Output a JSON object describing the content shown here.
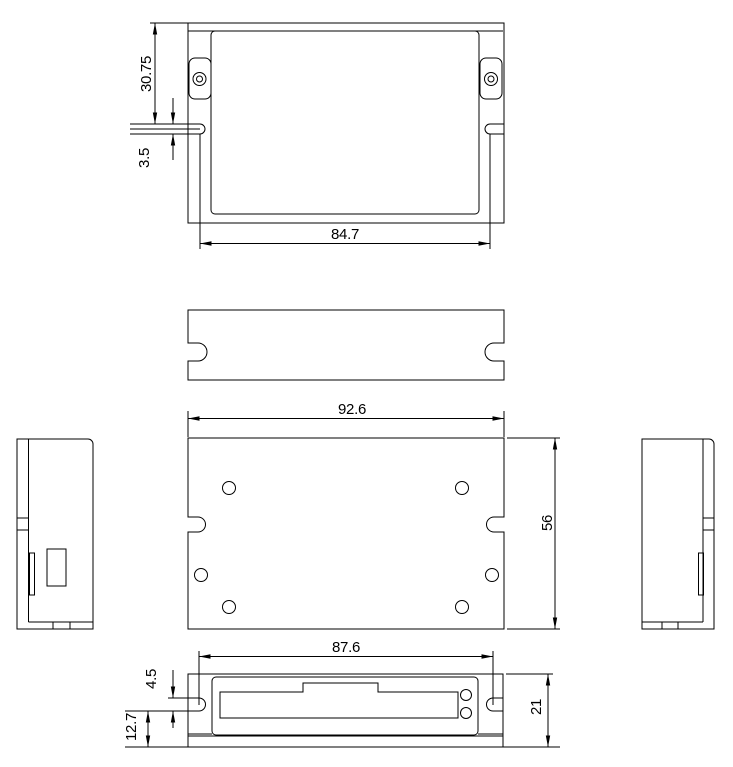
{
  "drawing": {
    "type": "mechanical-orthographic-views",
    "units_shown": false,
    "style": {
      "line_color": "#000000",
      "background_color": "#ffffff",
      "text_color": "#000000"
    }
  },
  "dims": {
    "top": {
      "edge_to_slot": "30.75",
      "slot_width": "3.5",
      "slot_spacing": "84.7"
    },
    "plan": {
      "overall_width": "92.6",
      "overall_depth": "56"
    },
    "front": {
      "slot_spacing": "87.6",
      "slot_width": "4.5",
      "slot_to_base": "12.7",
      "overall_height": "21"
    }
  }
}
